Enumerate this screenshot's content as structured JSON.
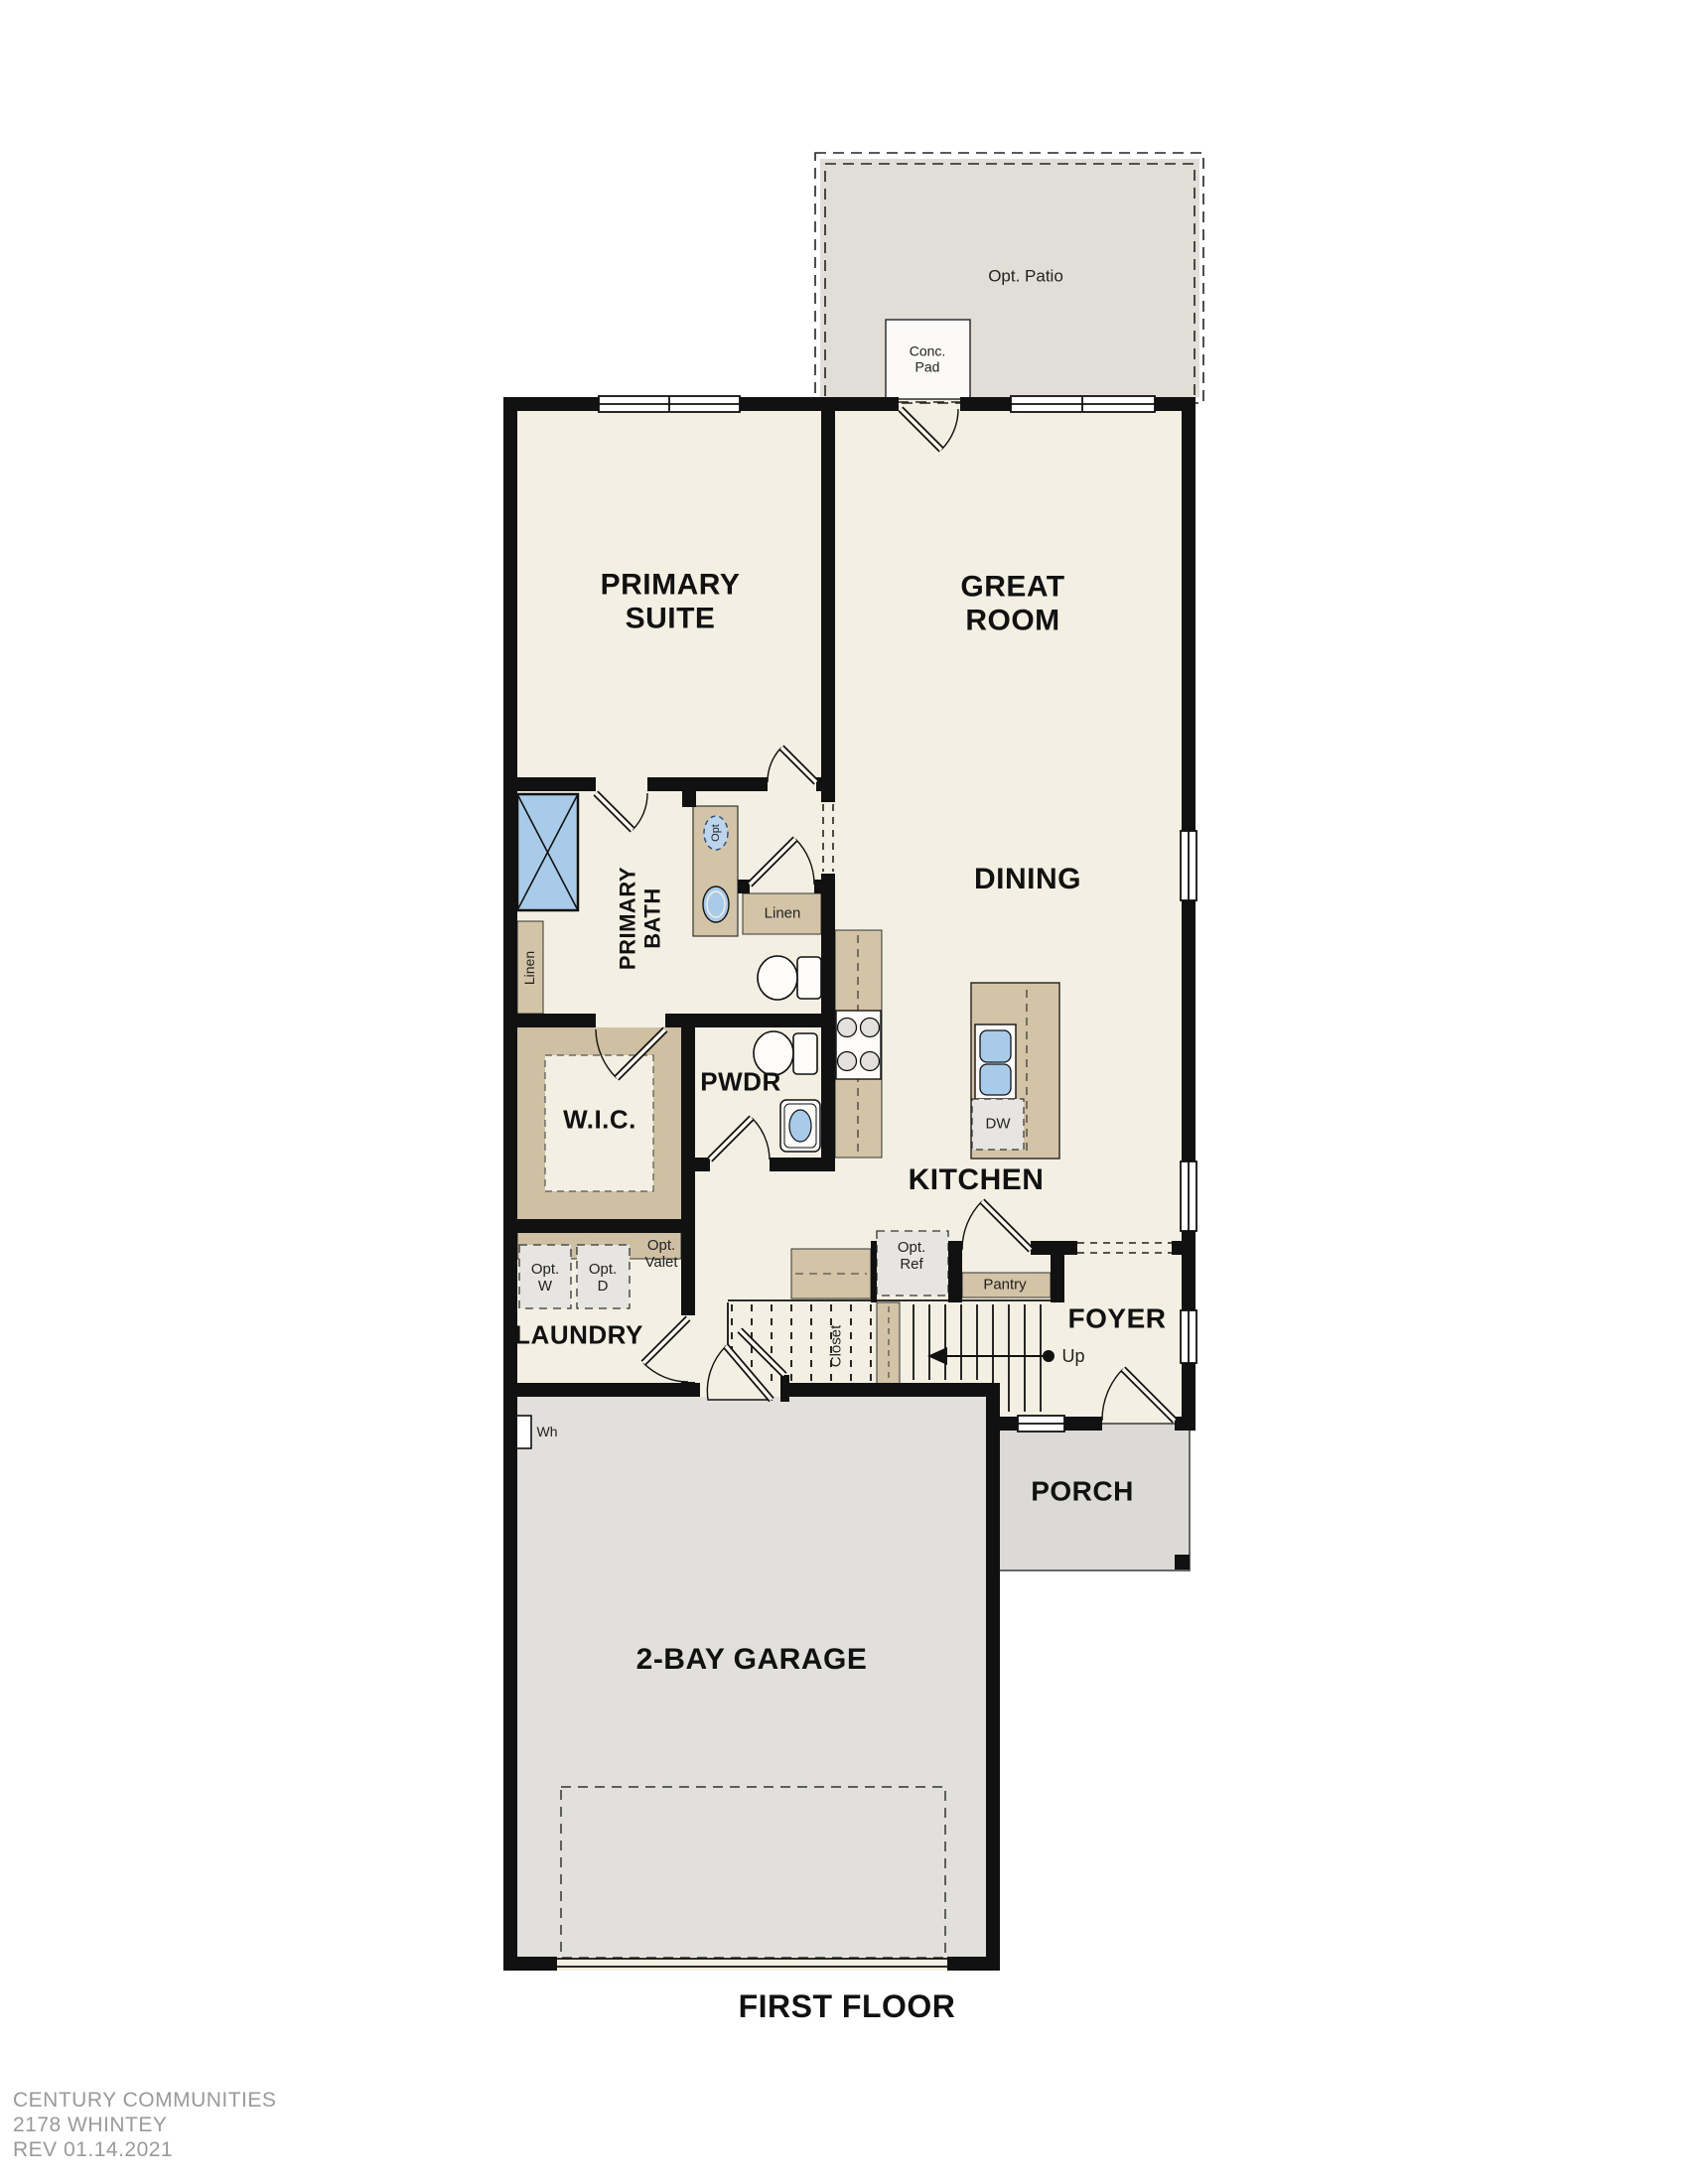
{
  "plan": {
    "title": "FIRST FLOOR",
    "rooms": {
      "primary_suite": "PRIMARY\nSUITE",
      "great_room": "GREAT\nROOM",
      "dining": "DINING",
      "kitchen": "KITCHEN",
      "primary_bath": "PRIMARY\nBATH",
      "wic": "W.I.C.",
      "pwdr": "PWDR",
      "laundry": "LAUNDRY",
      "foyer": "FOYER",
      "porch": "PORCH",
      "garage": "2-BAY GARAGE"
    },
    "features": {
      "opt_patio": "Opt. Patio",
      "conc_pad": "Conc.\nPad",
      "linen_bath": "Linen",
      "linen_hall": "Linen",
      "opt_sink": "Opt",
      "pantry": "Pantry",
      "closet": "Closet",
      "opt_ref": "Opt.\nRef",
      "opt_washer": "Opt.\nW",
      "opt_dryer": "Opt.\nD",
      "opt_valet": "Opt.\nValet",
      "dishwasher": "DW",
      "water_heater": "Wh",
      "stairs_up": "Up"
    },
    "footer": {
      "line1": "CENTURY COMMUNITIES",
      "line2": "2178 WHINTEY",
      "line3": "REV 01.14.2021"
    },
    "colors": {
      "floor": "#f4efe3",
      "patio": "#e1ded8",
      "porch": "#dcdad6",
      "garage_floor": "#e2e0dd",
      "cabinet_tan": "#d4c4a7",
      "fixture_blue": "#a9cbea",
      "appliance_gray": "#e7e5e2",
      "wall": "#111111",
      "footer_text": "#9a9a9a"
    }
  }
}
